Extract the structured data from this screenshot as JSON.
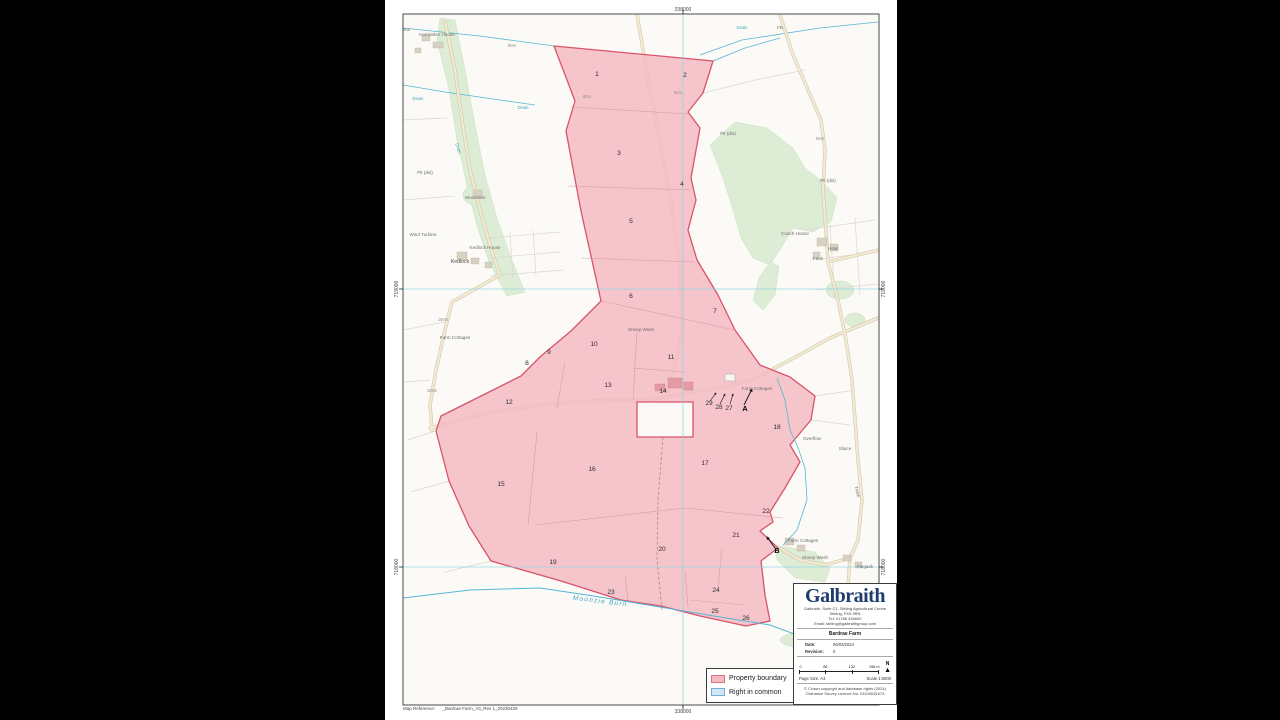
{
  "map": {
    "coords": {
      "top": "338000",
      "bottom": "338000",
      "left_top": "719000",
      "left_bottom": "718000",
      "right_top": "719000",
      "right_bottom": "718000"
    },
    "colors": {
      "property_fill": "#f3b9c1",
      "property_stroke": "#d9536a",
      "right_in_common_fill": "#cfe7f6",
      "water": "#56b6d2",
      "road": "#f3ead1",
      "woodland": "#dcecd5",
      "grid": "#8fd4e4"
    },
    "parcels": [
      {
        "label": "1",
        "x": 212,
        "y": 76
      },
      {
        "label": "2",
        "x": 300,
        "y": 77
      },
      {
        "label": "3",
        "x": 234,
        "y": 155
      },
      {
        "label": "4",
        "x": 297,
        "y": 186
      },
      {
        "label": "5",
        "x": 246,
        "y": 223
      },
      {
        "label": "6",
        "x": 246,
        "y": 298
      },
      {
        "label": "7",
        "x": 330,
        "y": 313
      },
      {
        "label": "8",
        "x": 142,
        "y": 365
      },
      {
        "label": "9",
        "x": 164,
        "y": 354
      },
      {
        "label": "10",
        "x": 209,
        "y": 346
      },
      {
        "label": "11",
        "x": 286,
        "y": 359
      },
      {
        "label": "12",
        "x": 124,
        "y": 404
      },
      {
        "label": "13",
        "x": 223,
        "y": 387
      },
      {
        "label": "14",
        "x": 278,
        "y": 393
      },
      {
        "label": "15",
        "x": 116,
        "y": 486
      },
      {
        "label": "16",
        "x": 207,
        "y": 471
      },
      {
        "label": "17",
        "x": 320,
        "y": 465
      },
      {
        "label": "18",
        "x": 392,
        "y": 429
      },
      {
        "label": "19",
        "x": 168,
        "y": 564
      },
      {
        "label": "20",
        "x": 277,
        "y": 551
      },
      {
        "label": "21",
        "x": 351,
        "y": 537
      },
      {
        "label": "22",
        "x": 381,
        "y": 513
      },
      {
        "label": "23",
        "x": 226,
        "y": 594
      },
      {
        "label": "24",
        "x": 331,
        "y": 592
      },
      {
        "label": "25",
        "x": 330,
        "y": 613
      },
      {
        "label": "26",
        "x": 361,
        "y": 620
      },
      {
        "label": "27",
        "x": 344,
        "y": 410
      },
      {
        "label": "28",
        "x": 334,
        "y": 409
      },
      {
        "label": "29",
        "x": 324,
        "y": 405
      },
      {
        "label": "A",
        "x": 360,
        "y": 411,
        "bold": true
      },
      {
        "label": "B",
        "x": 392,
        "y": 553,
        "bold": true
      }
    ],
    "labels": [
      {
        "text": "Feus",
        "x": 20,
        "y": 31,
        "cls": "place"
      },
      {
        "text": "Kerrielden House",
        "x": 52,
        "y": 36,
        "cls": "place"
      },
      {
        "text": "FB",
        "x": 395,
        "y": 29,
        "cls": "place"
      },
      {
        "text": "Drain",
        "x": 33,
        "y": 100,
        "cls": "water"
      },
      {
        "text": "Drain",
        "x": 138,
        "y": 109,
        "cls": "water"
      },
      {
        "text": "Drain",
        "x": 357,
        "y": 29,
        "cls": "water"
      },
      {
        "text": "Drain",
        "x": 72,
        "y": 149,
        "cls": "water",
        "rot": 72
      },
      {
        "text": "90m",
        "x": 127,
        "y": 47,
        "cls": "elev"
      },
      {
        "text": "93m",
        "x": 202,
        "y": 98,
        "cls": "elev"
      },
      {
        "text": "92m",
        "x": 293,
        "y": 94,
        "cls": "elev"
      },
      {
        "text": "Pit (dis)",
        "x": 40,
        "y": 174,
        "cls": "place"
      },
      {
        "text": "Woodside",
        "x": 90,
        "y": 199,
        "cls": "place"
      },
      {
        "text": "Wind Turbine",
        "x": 38,
        "y": 236,
        "cls": "place"
      },
      {
        "text": "Kedlock House",
        "x": 100,
        "y": 249,
        "cls": "place"
      },
      {
        "text": "Kedlock",
        "x": 75,
        "y": 263,
        "cls": "place-bold"
      },
      {
        "text": "Pit (dis)",
        "x": 343,
        "y": 135,
        "cls": "place"
      },
      {
        "text": "65m",
        "x": 435,
        "y": 140,
        "cls": "elev"
      },
      {
        "text": "Pit (dis)",
        "x": 443,
        "y": 182,
        "cls": "place"
      },
      {
        "text": "Coach House",
        "x": 410,
        "y": 235,
        "cls": "place"
      },
      {
        "text": "Hotel",
        "x": 448,
        "y": 250,
        "cls": "place"
      },
      {
        "text": "Feus",
        "x": 433,
        "y": 260,
        "cls": "place"
      },
      {
        "text": "Farm Cottages",
        "x": 70,
        "y": 339,
        "cls": "place"
      },
      {
        "text": "100m",
        "x": 58,
        "y": 321,
        "cls": "elev"
      },
      {
        "text": "103m",
        "x": 47,
        "y": 392,
        "cls": "elev"
      },
      {
        "text": "Sheep Wash",
        "x": 256,
        "y": 331,
        "cls": "place"
      },
      {
        "text": "Farm Cottages",
        "x": 372,
        "y": 390,
        "cls": "place"
      },
      {
        "text": "Overflow",
        "x": 427,
        "y": 440,
        "cls": "place"
      },
      {
        "text": "Sluice",
        "x": 460,
        "y": 450,
        "cls": "place"
      },
      {
        "text": "Track",
        "x": 471,
        "y": 492,
        "cls": "place",
        "rot": 75
      },
      {
        "text": "Farm Cottages",
        "x": 418,
        "y": 542,
        "cls": "place"
      },
      {
        "text": "Sheep Wash",
        "x": 430,
        "y": 559,
        "cls": "place"
      },
      {
        "text": "Fingask",
        "x": 480,
        "y": 568,
        "cls": "place"
      },
      {
        "text": "Moonzie Burn",
        "x": 215,
        "y": 603,
        "cls": "burn",
        "rot": 7
      }
    ]
  },
  "legend": {
    "items": [
      {
        "label": "Property boundary",
        "swatch": "#f3b9c1",
        "border": "#d9737f"
      },
      {
        "label": "Right in common",
        "swatch": "#cfe7f6",
        "border": "#74aed3"
      }
    ]
  },
  "infobox": {
    "brand": "Galbraith",
    "address_lines": [
      "Galbraith, Suite C1, Stirling Agricultural Centre",
      "Stirling, FK9 4RN",
      "Tel: 01786 434600",
      "Email: stirling@galbraithgroup.com"
    ],
    "title": "Bardrae Farm",
    "date_label": "Date:",
    "date_value": "06/03/2024",
    "revision_label": "Revision:",
    "revision_value": "0",
    "scalebar": {
      "ticks": [
        "0",
        "66",
        "132",
        "198 m"
      ],
      "north": "N"
    },
    "page_size": "Page Size: A3",
    "scale": "Scale 1:6000",
    "copyright_lines": [
      "© Crown copyright and database rights (2024)",
      "Ordnance Survey Licence No. 01100031673"
    ]
  },
  "footer": {
    "map_reference": "Map Reference:      _Bardrae Farm_A3_Rev 1_20230426"
  }
}
